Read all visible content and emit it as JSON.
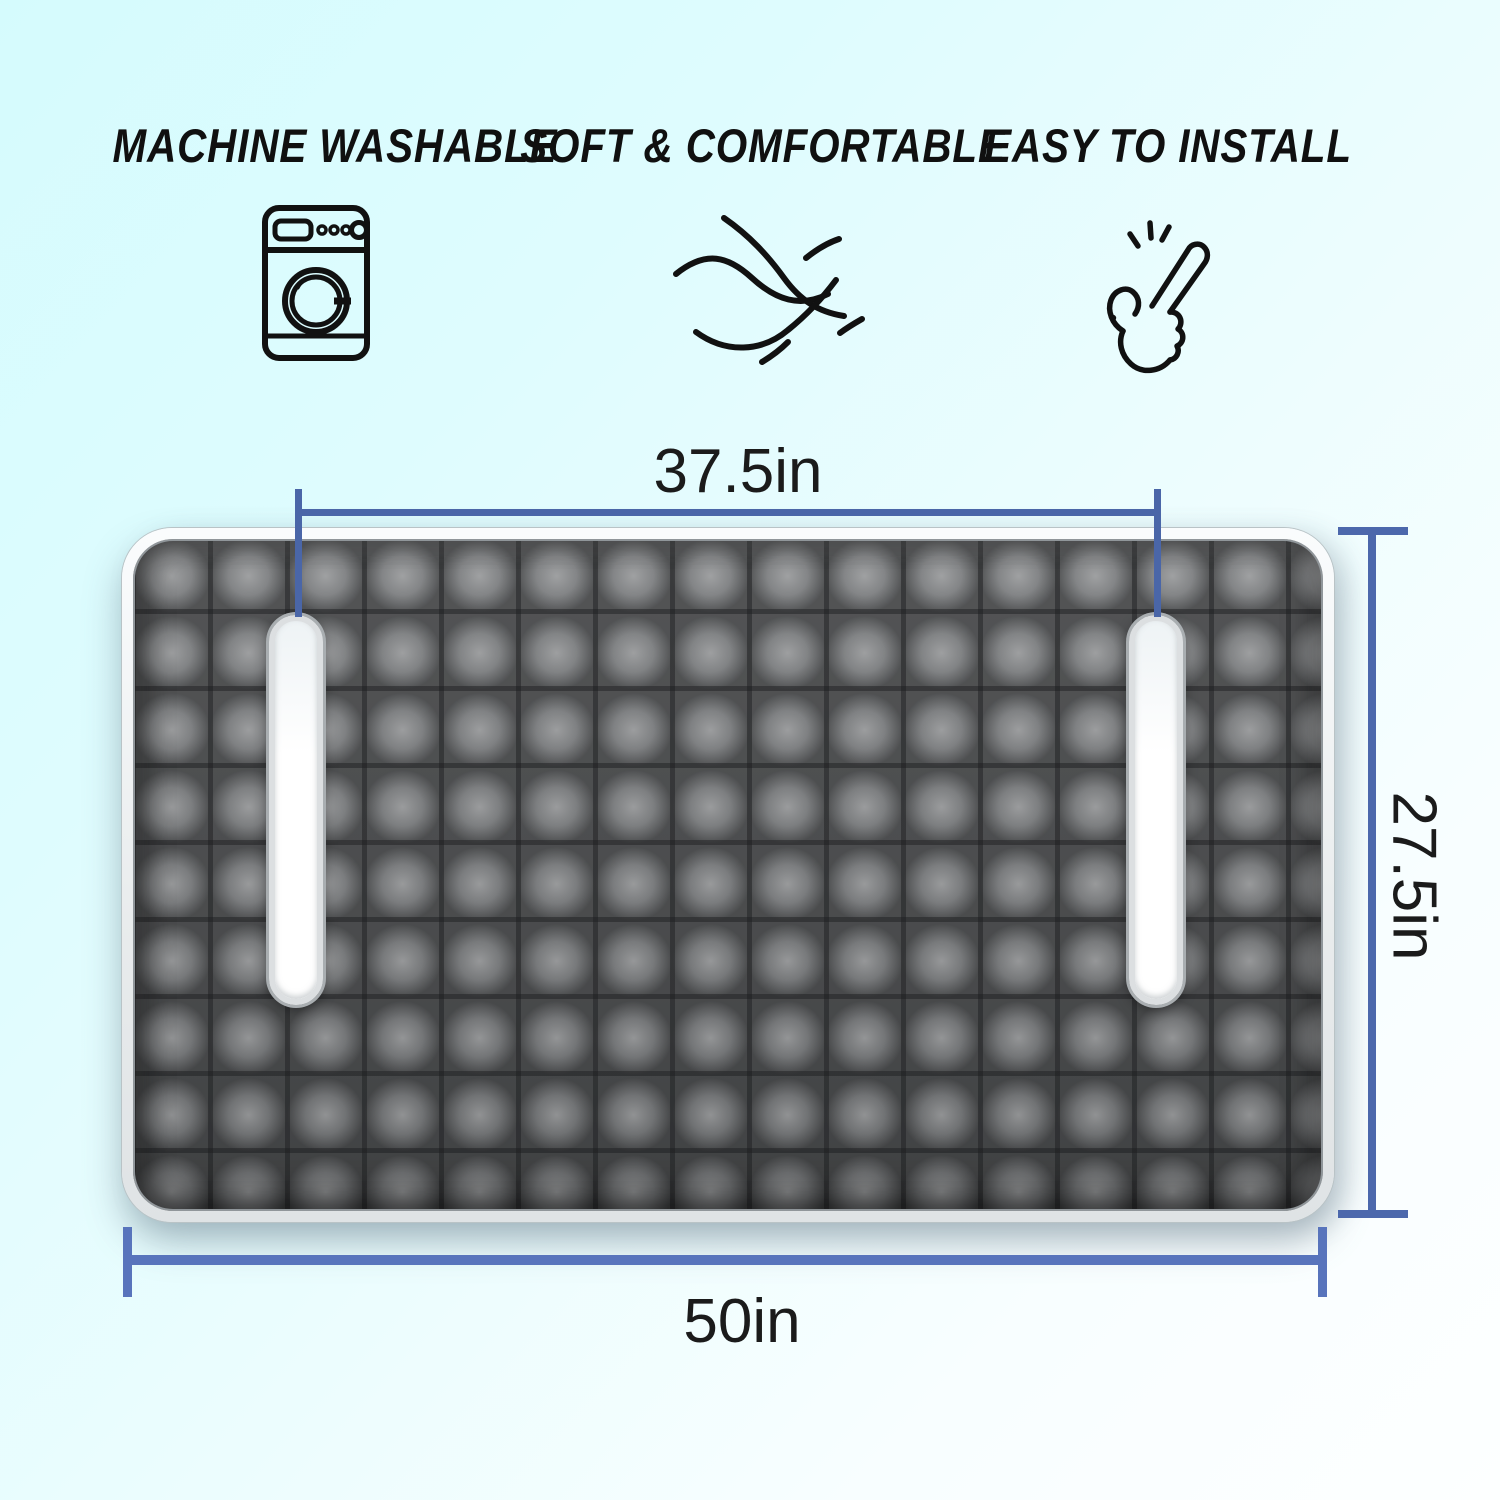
{
  "features": [
    {
      "label": "MACHINE WASHABLE",
      "icon": "washing-machine-icon"
    },
    {
      "label": "SOFT & COMFORTABLE",
      "icon": "fabric-weave-icon"
    },
    {
      "label": "EASY TO INSTALL",
      "icon": "snap-fingers-icon"
    }
  ],
  "dimensions": {
    "top_width": {
      "label": "37.5in"
    },
    "side_height": {
      "label": "27.5in"
    },
    "bottom_width": {
      "label": "50in"
    }
  },
  "colors": {
    "dimension_line_top": "#4a66a8",
    "dimension_line_side": "#4c68ac",
    "dimension_line_bottom": "#5874bc",
    "mat_plush_gray": "#6f7173",
    "mat_seam_gray": "#4e5052",
    "mat_piping_white": "#eef0f2",
    "background_top_left": "#d5fbfd",
    "background_bottom_right": "#fdffff",
    "heading_text": "#101010",
    "dimension_text": "#1b1b1b"
  }
}
